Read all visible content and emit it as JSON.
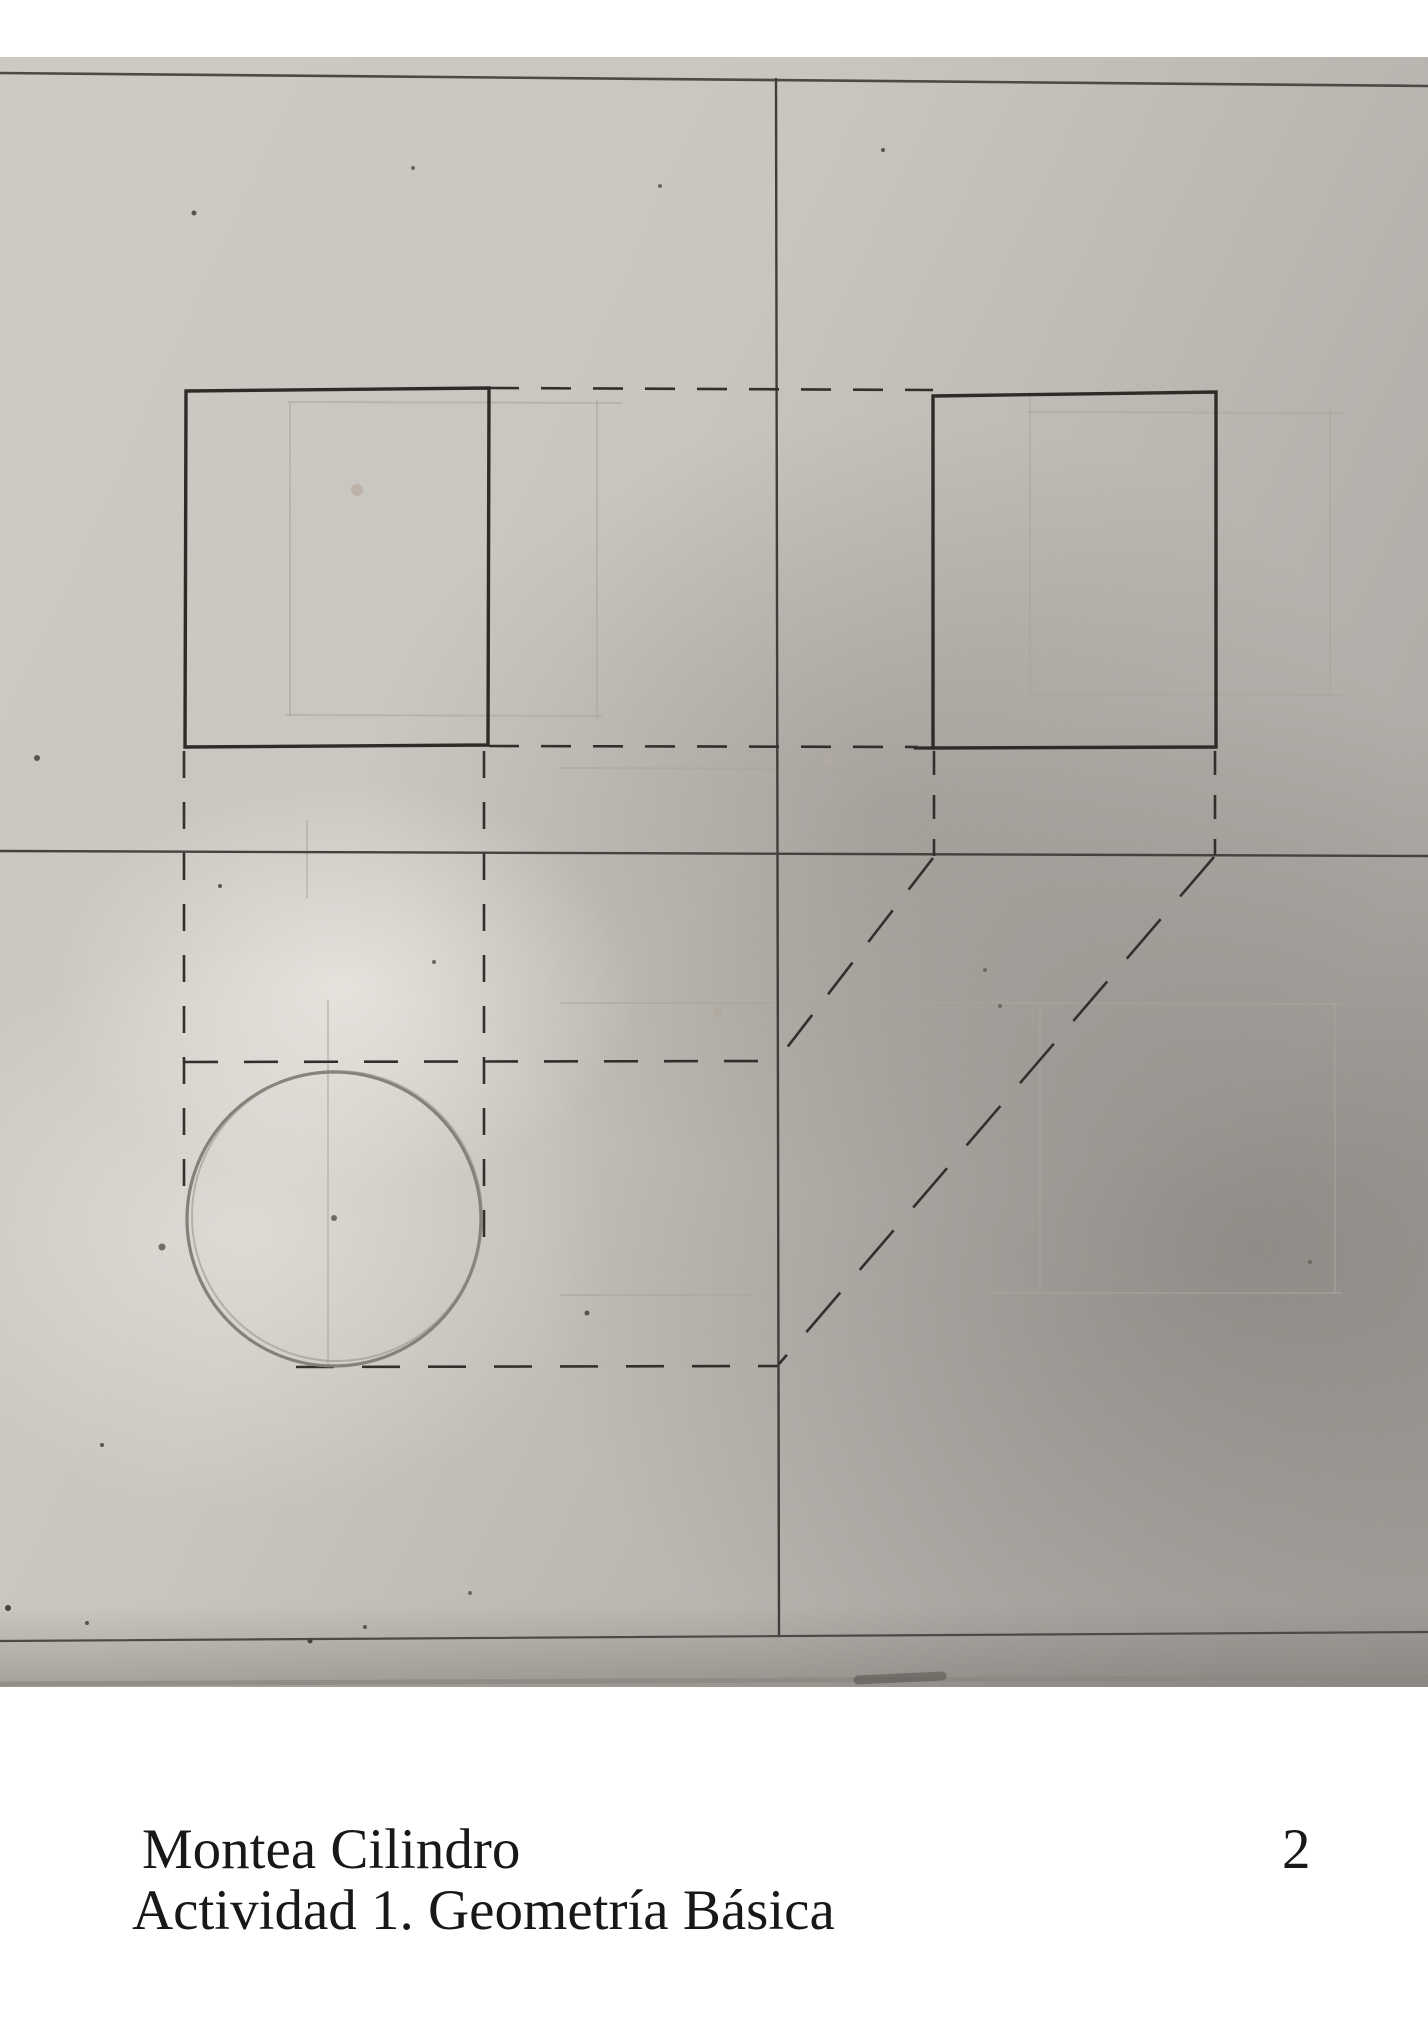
{
  "caption": {
    "title": "Montea Cilindro",
    "subtitle": "Actividad 1. Geometría Básica",
    "page_number": "2"
  },
  "drawing": {
    "ink": "#32302d",
    "pencil": "#7f7c76",
    "faint": "#a9a59e",
    "polylines": [
      {
        "name": "front-view-rectangle",
        "points": [
          [
            186,
            391
          ],
          [
            489,
            388
          ],
          [
            488,
            745
          ],
          [
            185,
            747
          ]
        ],
        "close": true,
        "w": 3.4,
        "c": "#2e2c29"
      },
      {
        "name": "side-view-rectangle",
        "points": [
          [
            933,
            396
          ],
          [
            1216,
            392
          ],
          [
            1216,
            747
          ],
          [
            933,
            748
          ]
        ],
        "close": true,
        "w": 3.4,
        "c": "#2e2c29"
      }
    ],
    "lines": [
      {
        "name": "sheet-top-border",
        "x1": 0,
        "y1": 73,
        "x2": 1428,
        "y2": 86,
        "w": 2.6,
        "c": "#4c4a46"
      },
      {
        "name": "fold-line-vertical",
        "x1": 776,
        "y1": 79,
        "x2": 779,
        "y2": 1636,
        "w": 2.4,
        "c": "#403e3a"
      },
      {
        "name": "ground-line",
        "x1": 0,
        "y1": 851,
        "x2": 1428,
        "y2": 856,
        "w": 2.4,
        "c": "#45433f"
      },
      {
        "name": "sheet-bottom-border",
        "x1": 0,
        "y1": 1641,
        "x2": 1428,
        "y2": 1632,
        "w": 2.2,
        "c": "#4c4a46"
      },
      {
        "name": "photo-bottom-edge",
        "x1": 0,
        "y1": 1684,
        "x2": 1428,
        "y2": 1677,
        "w": 5,
        "c": "#8b8882",
        "o": 0.75
      },
      {
        "name": "photo-bottom-smudge",
        "x1": 858,
        "y1": 1680,
        "x2": 942,
        "y2": 1676,
        "w": 9,
        "c": "#55524d",
        "o": 0.55
      },
      {
        "name": "side-rect-bottom-overshoot",
        "x1": 915,
        "y1": 748,
        "x2": 935,
        "y2": 748,
        "w": 3.2,
        "c": "#2e2c29"
      }
    ],
    "dashed": [
      {
        "name": "projection-top",
        "x1": 489,
        "y1": 388,
        "x2": 933,
        "y2": 390,
        "dash": "30 22"
      },
      {
        "name": "projection-bottom",
        "x1": 489,
        "y1": 746,
        "x2": 918,
        "y2": 747,
        "dash": "30 22"
      },
      {
        "name": "projection-left-vertical",
        "x1": 184,
        "y1": 751,
        "x2": 184,
        "y2": 1198,
        "dash": "27 24"
      },
      {
        "name": "projection-right-vertical",
        "x1": 484,
        "y1": 751,
        "x2": 484,
        "y2": 1240,
        "dash": "27 24"
      },
      {
        "name": "side-left-extension",
        "x1": 934,
        "y1": 751,
        "x2": 934,
        "y2": 856,
        "dash": "24 20"
      },
      {
        "name": "side-right-extension",
        "x1": 1215,
        "y1": 751,
        "x2": 1215,
        "y2": 855,
        "dash": "24 20"
      },
      {
        "name": "miter-diagonal-short",
        "x1": 933,
        "y1": 858,
        "x2": 779,
        "y2": 1058,
        "dash": "40 26"
      },
      {
        "name": "miter-diagonal-long",
        "x1": 1214,
        "y1": 857,
        "x2": 779,
        "y2": 1364,
        "dash": "52 30"
      },
      {
        "name": "top-view-upper-edge",
        "x1": 184,
        "y1": 1062,
        "x2": 778,
        "y2": 1061,
        "dash": "34 26"
      },
      {
        "name": "top-view-lower-edge",
        "x1": 296,
        "y1": 1367,
        "x2": 778,
        "y2": 1366,
        "dash": "38 28"
      }
    ],
    "circle": {
      "cx": 334,
      "cy": 1219,
      "r": 147,
      "w": 3.2,
      "c": "#7f7c76",
      "o": 0.95
    },
    "circle2": {
      "cx": 337,
      "cy": 1216,
      "r": 145,
      "w": 2,
      "c": "#8d8a84",
      "o": 0.5
    },
    "center_dot": {
      "cx": 334,
      "cy": 1218,
      "r": 3,
      "c": "#6f6c66"
    },
    "faint_lines": [
      [
        290,
        402,
        290,
        716
      ],
      [
        597,
        400,
        597,
        718
      ],
      [
        288,
        402,
        622,
        403
      ],
      [
        285,
        715,
        602,
        716
      ],
      [
        1030,
        396,
        1030,
        699
      ],
      [
        1330,
        410,
        1330,
        696
      ],
      [
        1028,
        412,
        1342,
        413
      ],
      [
        1028,
        694,
        1342,
        695
      ],
      [
        1040,
        1004,
        1040,
        1294
      ],
      [
        1335,
        1004,
        1335,
        1294
      ],
      [
        1012,
        1003,
        1342,
        1004
      ],
      [
        988,
        1293,
        1342,
        1293
      ],
      [
        560,
        768,
        930,
        769
      ],
      [
        560,
        1003,
        1040,
        1003
      ],
      [
        328,
        1000,
        328,
        1368
      ],
      [
        307,
        820,
        307,
        898
      ],
      [
        560,
        1295,
        752,
        1295
      ]
    ],
    "specks": [
      [
        194,
        213,
        2.5,
        "#57544f",
        1
      ],
      [
        883,
        150,
        2,
        "#57544f",
        1
      ],
      [
        660,
        186,
        2,
        "#6b6862",
        1
      ],
      [
        413,
        168,
        2,
        "#6b6862",
        1
      ],
      [
        37,
        758,
        3,
        "#57544f",
        1
      ],
      [
        220,
        886,
        2,
        "#57544f",
        1
      ],
      [
        102,
        1445,
        2,
        "#57544f",
        1
      ],
      [
        8,
        1608,
        3,
        "#45433f",
        1
      ],
      [
        87,
        1623,
        2,
        "#57544f",
        1
      ],
      [
        365,
        1627,
        2,
        "#57544f",
        1
      ],
      [
        310,
        1641,
        2.5,
        "#45433f",
        1
      ],
      [
        470,
        1593,
        2,
        "#6b6862",
        1
      ],
      [
        985,
        970,
        2,
        "#6b6862",
        1
      ],
      [
        1000,
        1006,
        2,
        "#6b6862",
        1
      ],
      [
        587,
        1313,
        2.5,
        "#57544f",
        1
      ],
      [
        1310,
        1262,
        2,
        "#6b6862",
        1
      ],
      [
        434,
        962,
        2,
        "#6b6862",
        1
      ],
      [
        162,
        1247,
        3.5,
        "#55524d",
        0.8
      ],
      [
        357,
        490,
        6,
        "#b3a597",
        0.6
      ],
      [
        718,
        1012,
        5,
        "#b3a79b",
        0.55
      ],
      [
        830,
        760,
        5,
        "#b9ada1",
        0.5
      ]
    ]
  }
}
